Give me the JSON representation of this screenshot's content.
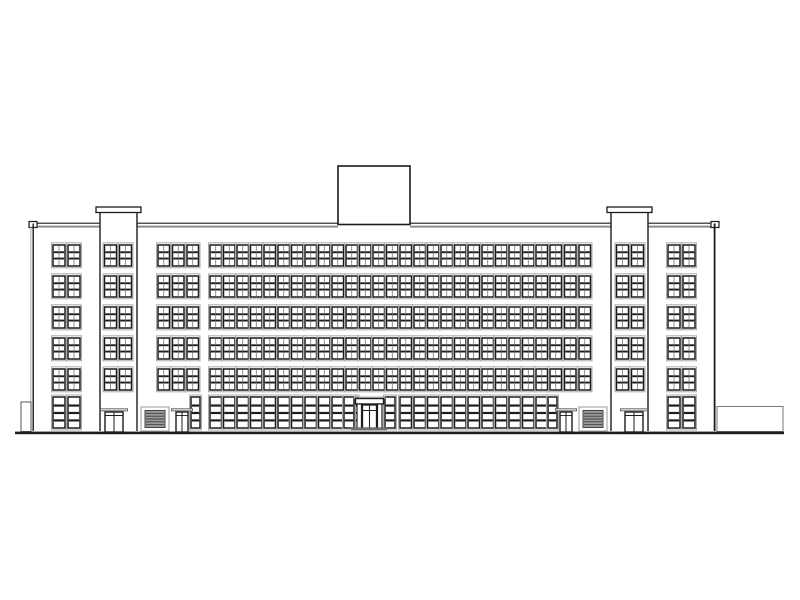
{
  "meta": {
    "type": "architectural-elevation-drawing",
    "subject": "front elevation of a symmetric six-storey building with two stair towers, central rooftop penthouse, central entrance portico, side louver grilles and a low right-side annex"
  },
  "canvas": {
    "w": 800,
    "h": 600,
    "background": "#ffffff"
  },
  "palette": {
    "paper": "#ffffff",
    "ink": "#1c1c1c",
    "mid": "#666666",
    "light": "#ababab",
    "shadow": "#8c8c8c",
    "louver_fill": "#9c9c9c",
    "louver_slat": "#3d3d3d",
    "platform": "#6e6e6e"
  },
  "ground_line": {
    "x": 15,
    "w": 769,
    "y": 431.6,
    "h": 2.6
  },
  "main_block": {
    "left_wall_x": 33.2,
    "left_wall_inner_x": 30.8,
    "right_wall_x": 714.6,
    "roof_y": 223.5,
    "bottom_y": 431,
    "parapet_line1_y": 223.2,
    "parapet_line2_y": 226.6,
    "parapet_segments": [
      [
        33,
        100
      ],
      [
        137,
        338
      ],
      [
        410,
        611
      ],
      [
        648,
        715
      ]
    ],
    "parapet_shadow_segments": [
      [
        29,
        100
      ],
      [
        137,
        338
      ],
      [
        410,
        611
      ],
      [
        648,
        719
      ]
    ],
    "copings": [
      {
        "x": 29,
        "y": 221.5,
        "w": 8,
        "h": 6
      },
      {
        "x": 711,
        "y": 221.5,
        "w": 8,
        "h": 6
      }
    ]
  },
  "penthouse": {
    "x": 338,
    "y": 166,
    "w": 72,
    "h": 58.5
  },
  "towers": [
    {
      "name": "left-tower",
      "x": 100,
      "w": 37,
      "cap": {
        "x": 96,
        "y": 207,
        "w": 45,
        "h": 5.5
      },
      "windows": [
        104.5,
        119.5
      ],
      "door": {
        "x": 105,
        "w": 18
      }
    },
    {
      "name": "right-tower",
      "x": 611,
      "w": 37,
      "cap": {
        "x": 607,
        "y": 207,
        "w": 45,
        "h": 5.5
      },
      "windows": [
        616.5,
        631.5
      ],
      "door": {
        "x": 625,
        "w": 18
      }
    }
  ],
  "floors": {
    "upper_rows_y": [
      245,
      276,
      307,
      338,
      369
    ],
    "upper_h": 21,
    "ground_y": 397,
    "ground_h": 31
  },
  "windows": {
    "wing_w": 12,
    "facade_w": 11.5,
    "wing_left": [
      53,
      68
    ],
    "wing_right": [
      668,
      683
    ],
    "facade_groups": [
      [
        158,
        172.5,
        187
      ],
      [
        210,
        223.5,
        237,
        250.5,
        264
      ],
      [
        278,
        291.5,
        305,
        318.5,
        332
      ],
      [
        346,
        359.5,
        373,
        386.5,
        400
      ],
      [
        414,
        427.5,
        441,
        454.5,
        468
      ],
      [
        482,
        495.5,
        509,
        522.5,
        536
      ],
      [
        550,
        564.5,
        579
      ]
    ]
  },
  "ground_floor": {
    "wing_windows_left": [
      53,
      68
    ],
    "wing_windows_right": [
      668,
      683
    ],
    "facade_windows": [
      210,
      223.5,
      237,
      250.5,
      264,
      278,
      291.5,
      305,
      318.5,
      332,
      346,
      400,
      414,
      427.5,
      441,
      454.5,
      468,
      482,
      495.5,
      509,
      522.5,
      536
    ],
    "narrow_windows": [
      {
        "x": 191,
        "w": 9
      },
      {
        "x": 548,
        "w": 9
      }
    ],
    "louvers": [
      {
        "x": 141,
        "y": 407,
        "w": 28,
        "h": 24
      },
      {
        "x": 579,
        "y": 407,
        "w": 28,
        "h": 24
      }
    ],
    "side_doors": [
      {
        "x": 176,
        "w": 12
      },
      {
        "x": 560,
        "w": 12
      }
    ],
    "door_y": 412,
    "door_h": 20,
    "entrance": {
      "canopy": {
        "x": 355.5,
        "y": 398.5,
        "w": 28,
        "h": 5.5
      },
      "pillars": [
        {
          "x": 357,
          "w": 4.5
        },
        {
          "x": 377.5,
          "w": 4.5
        }
      ],
      "pillar_y": 404,
      "pillar_h": 24,
      "frame": {
        "x": 362.5,
        "y": 405,
        "w": 14,
        "h": 23
      },
      "transom_y": 410.5,
      "platform": {
        "x": 351,
        "y": 427.5,
        "w": 36,
        "h": 3
      },
      "flank_windows": [
        {
          "x": 344,
          "w": 10
        },
        {
          "x": 385,
          "w": 10
        }
      ]
    }
  },
  "annex_right": {
    "x": 717,
    "y": 406.5,
    "w": 66,
    "h": 25
  },
  "step_left": {
    "x": 21,
    "y": 402,
    "w": 10,
    "h": 29.5
  }
}
